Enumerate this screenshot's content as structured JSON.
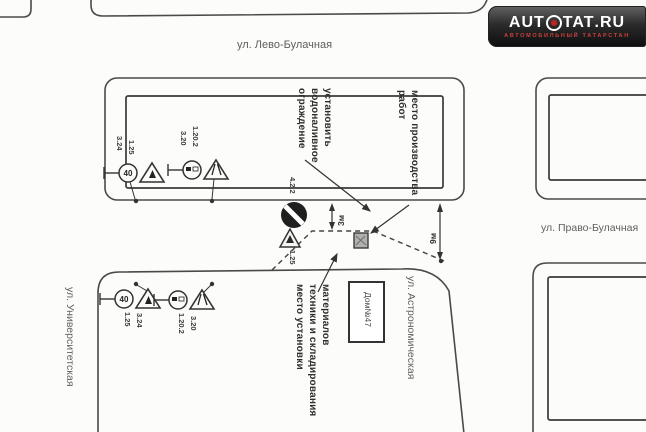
{
  "logo": {
    "brand_left": "AUT",
    "brand_right": "TAT",
    "tld": ".RU",
    "tagline": "АВТОМОБИЛЬНЫЙ ТАТАРСТАН",
    "icon": "steering-wheel-icon"
  },
  "streets": {
    "top": "ул. Лево-Булачная",
    "right": "ул. Право-Булачная",
    "left": "ул. Университетская",
    "center": "ул. Астрономическая"
  },
  "notes": {
    "barrier": [
      "установить",
      "водоналивное",
      "ограждение"
    ],
    "work_zone": [
      "место производства",
      "работ"
    ],
    "equipment": [
      "место установки",
      "техники и складирования",
      "материалов"
    ],
    "house": "Дом№47"
  },
  "dimensions": {
    "offset": "3м",
    "road_width": "9м"
  },
  "signs": {
    "speed_value": "40",
    "top_left": {
      "circle": "3.24",
      "triangle": "1.25"
    },
    "top_right": {
      "circle": "3.20",
      "triangle": "1.20.2"
    },
    "bottom_left": {
      "circle": "3.24",
      "triangle": "1.25"
    },
    "bottom_right": {
      "circle": "3.20",
      "triangle": "1.20.2"
    },
    "center": {
      "detour": "4.2.2",
      "works": "1.25"
    }
  }
}
